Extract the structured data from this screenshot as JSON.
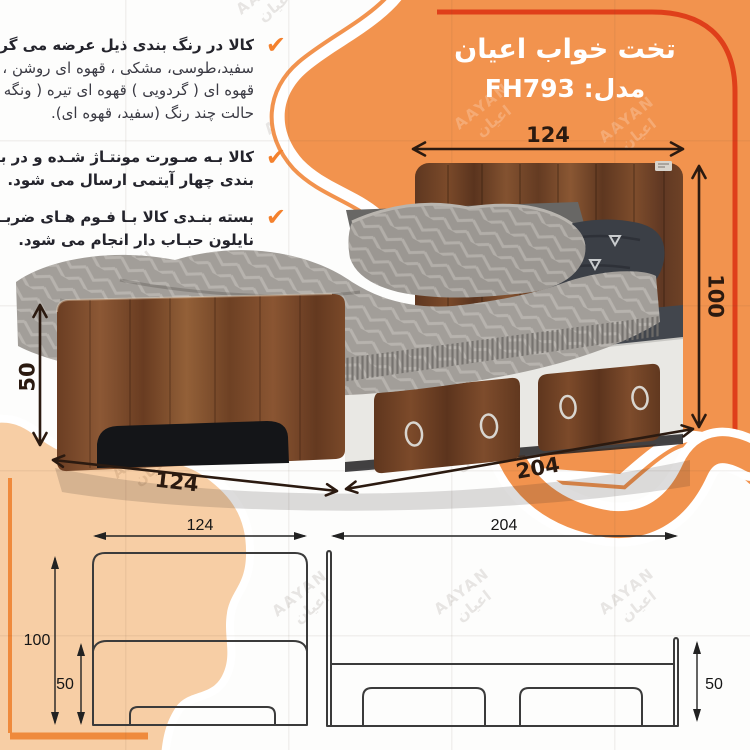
{
  "header": {
    "title": "تخت خواب اعیان",
    "model_label": "مدل: FH793"
  },
  "info": {
    "check_glyph": "✔",
    "bullet1": {
      "l1": "کالا در رنگ بندی ذیل عرضه می گردد:",
      "l2": "سفید،طوسی، مشکی ، قهوه ای روشن ،",
      "l3": "قهوه ای ( گردویی ) قهوه ای تیره ( ونگه ) و",
      "l4": "حالت چند رنگ (سفید، قهوه ای)."
    },
    "bullet2": {
      "l1": "کالا بـه صـورت مونتـاژ شـده و در بستـه",
      "l2": "بندی چهار آیتمی ارسال می شود."
    },
    "bullet3": {
      "l1": "بسته بنـدی کالا بـا فـوم هـای ضربـه گیـر و",
      "l2": "نایلون حبـاب دار انجام می شود."
    }
  },
  "photo_dims": {
    "top_width": "124",
    "right_height": "100",
    "left_height": "50",
    "bottom_width": "124",
    "bottom_depth": "204"
  },
  "drawing_dims": {
    "front_width": "124",
    "front_height": "100",
    "front_base": "50",
    "side_length": "204",
    "side_base": "50"
  },
  "watermark": {
    "line1": "AAYAN",
    "line2": "اعیان"
  },
  "colors": {
    "orange": "#F2934E",
    "orange_accent": "#EF8A3C",
    "red_accent": "#DF3F1A",
    "peach": "#F7CEA5",
    "annotation": "#2B1A10",
    "drawing_line": "#3B3B3B"
  }
}
